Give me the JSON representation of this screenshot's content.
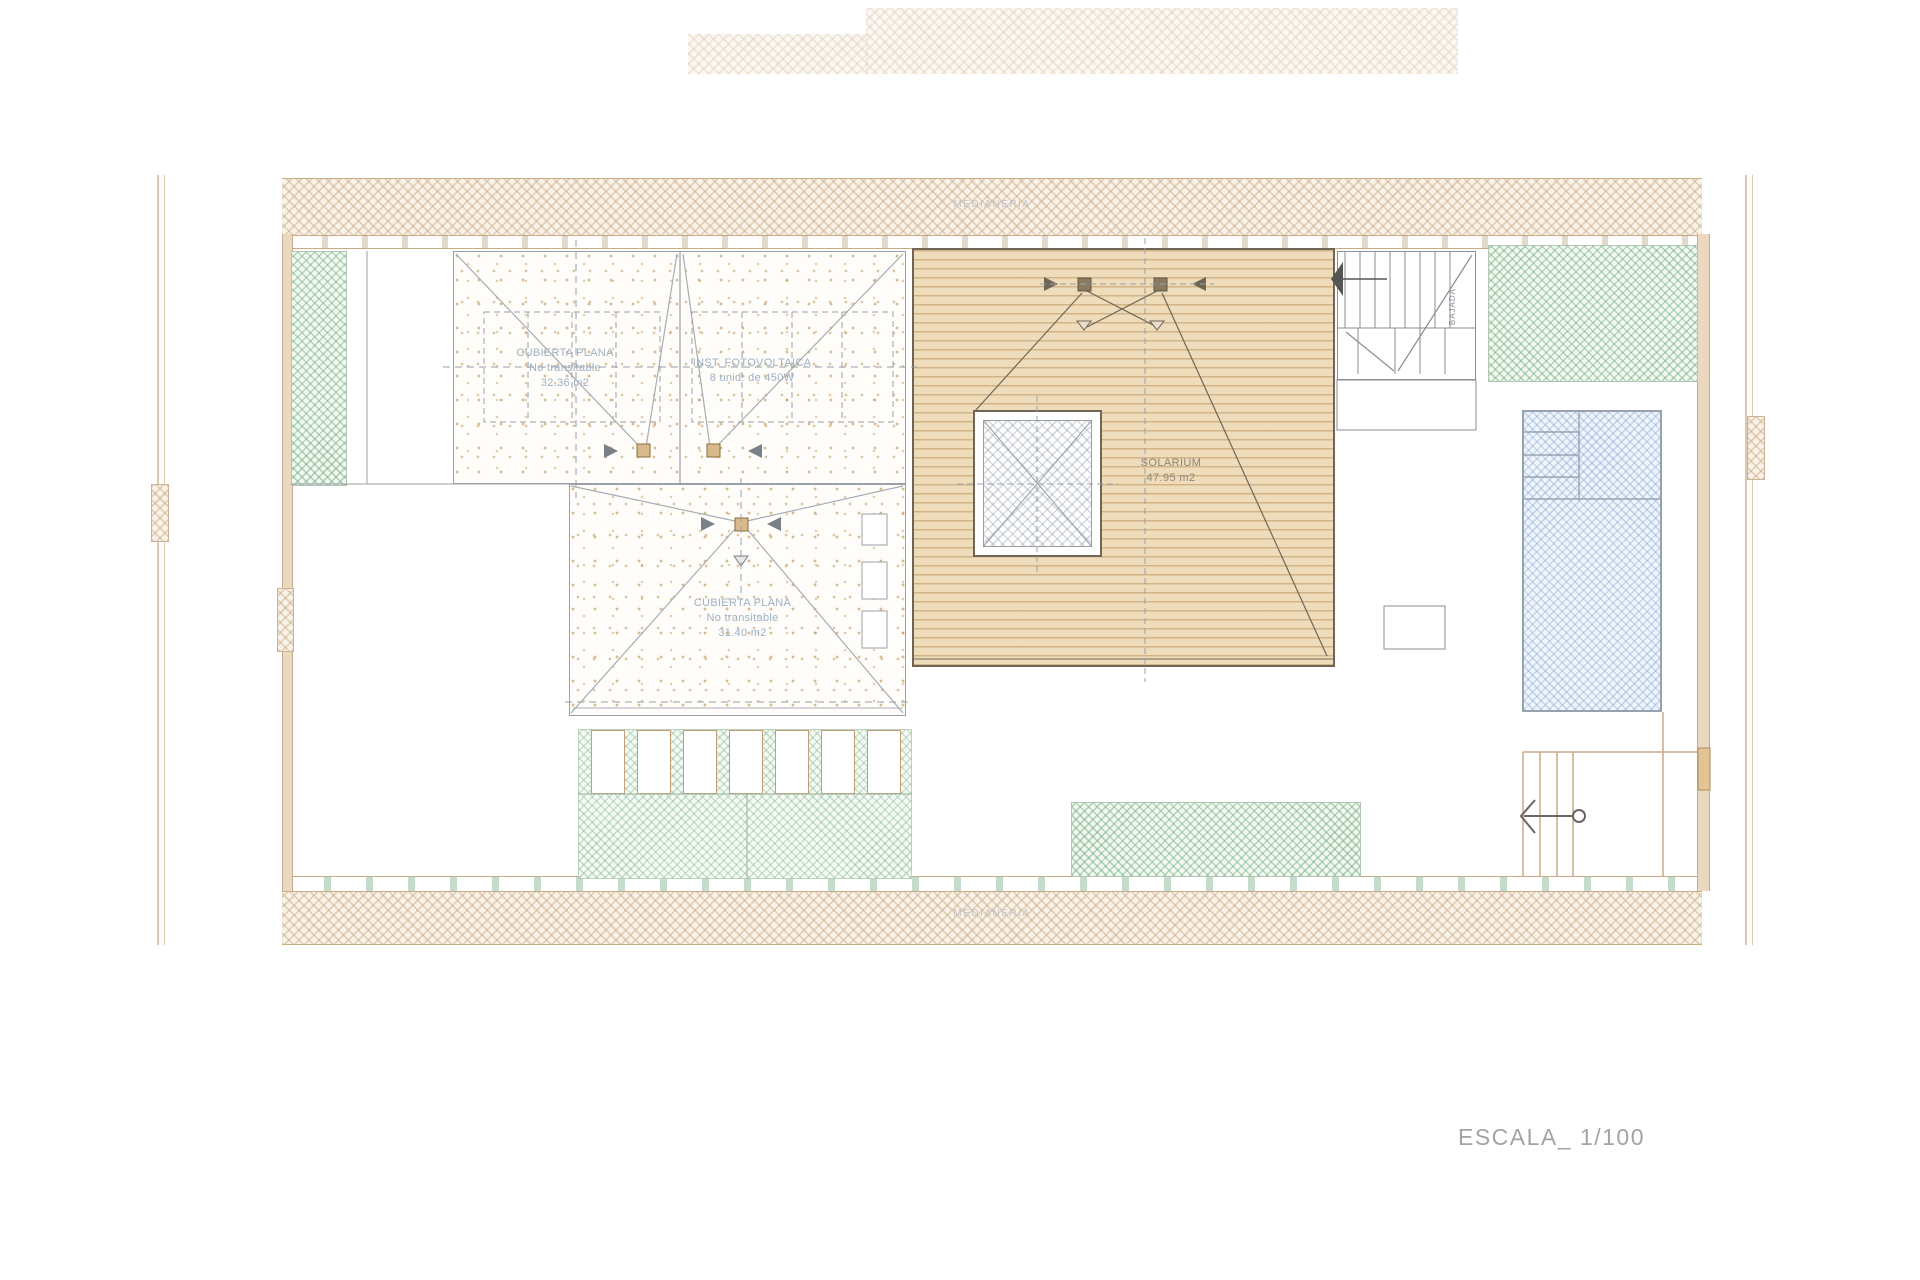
{
  "plan": {
    "scale_label": "ESCALA_ 1/100",
    "party_wall_top": "MEDIANERIA",
    "party_wall_bottom": "MEDIANERIA",
    "roof_flat_left": {
      "title": "CUBIERTA PLANA",
      "subtitle": "No transitable",
      "area": "32.36 m2"
    },
    "photovoltaic": {
      "title": "INST. FOTOVOLTAICA",
      "subtitle": "8 unid. de 450W"
    },
    "roof_flat_center": {
      "title": "CUBIERTA PLANA",
      "subtitle": "No transitable",
      "area": "31.40 m2"
    },
    "solarium": {
      "title": "SOLARIUM",
      "area": "47.95 m2"
    },
    "stair_label": "BAJADA",
    "colors": {
      "wall_hatch_tan": "#c5a076",
      "green_hatch": "#68a878",
      "pool_blue": "#84a4d0",
      "deck_tan": "#eedcba",
      "deck_line": "#b0824a",
      "label_blue": "#9db0c4",
      "line_gray": "#8a9096",
      "line_tan": "#c9ab85"
    }
  }
}
